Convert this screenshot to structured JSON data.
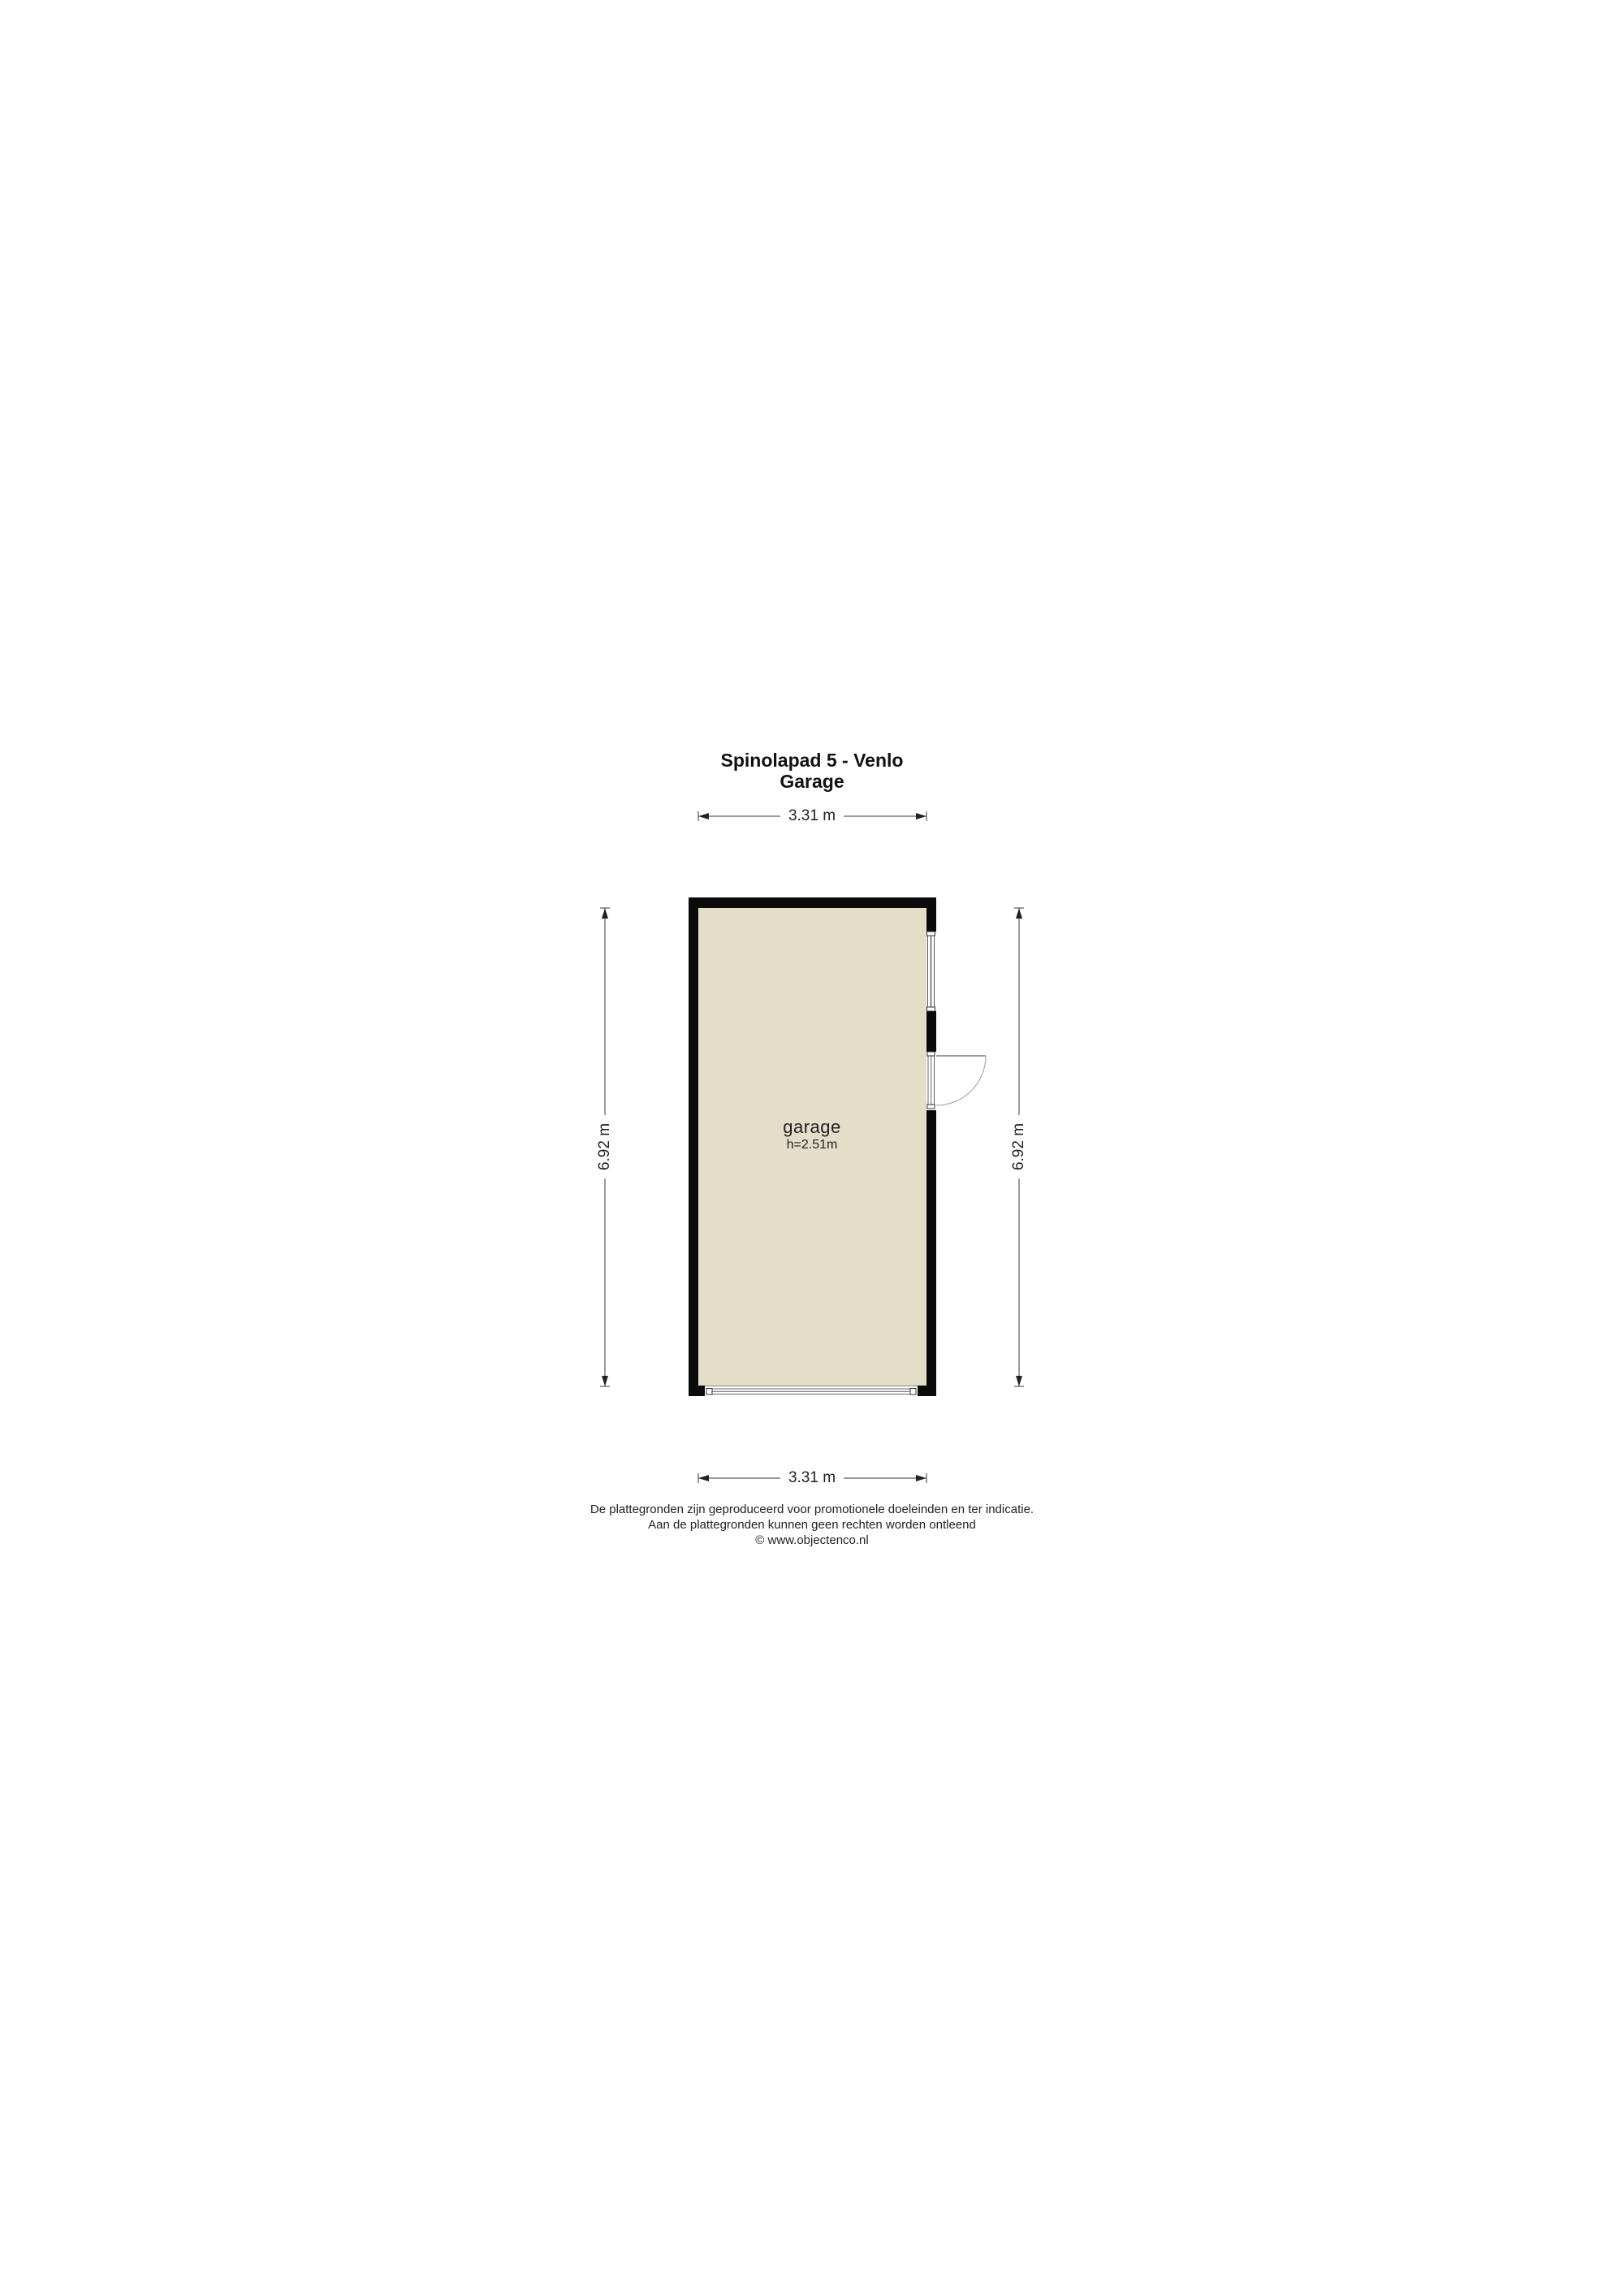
{
  "title": {
    "line1": "Spinolapad 5 - Venlo",
    "line2": "Garage"
  },
  "floor_plan": {
    "room": {
      "label": "garage",
      "ceiling_height": "h=2.51m"
    },
    "dimensions": {
      "width_top": "3.31 m",
      "width_bottom": "3.31 m",
      "height_left": "6.92 m",
      "height_right": "6.92 m"
    },
    "symbols": [
      "window",
      "swing-door",
      "garage-door-opening"
    ]
  },
  "footer": {
    "disclaimer_line1": "De plattegronden zijn geproduceerd voor promotionele doeleinden en ter indicatie.",
    "disclaimer_line2": "Aan de plattegronden kunnen geen rechten worden ontleend",
    "copyright": "© www.objectenco.nl"
  },
  "colors": {
    "wall": "#0a0a0a",
    "floor": "#e3dec7",
    "dimension_line": "#3a3a3a",
    "background": "#ffffff"
  }
}
